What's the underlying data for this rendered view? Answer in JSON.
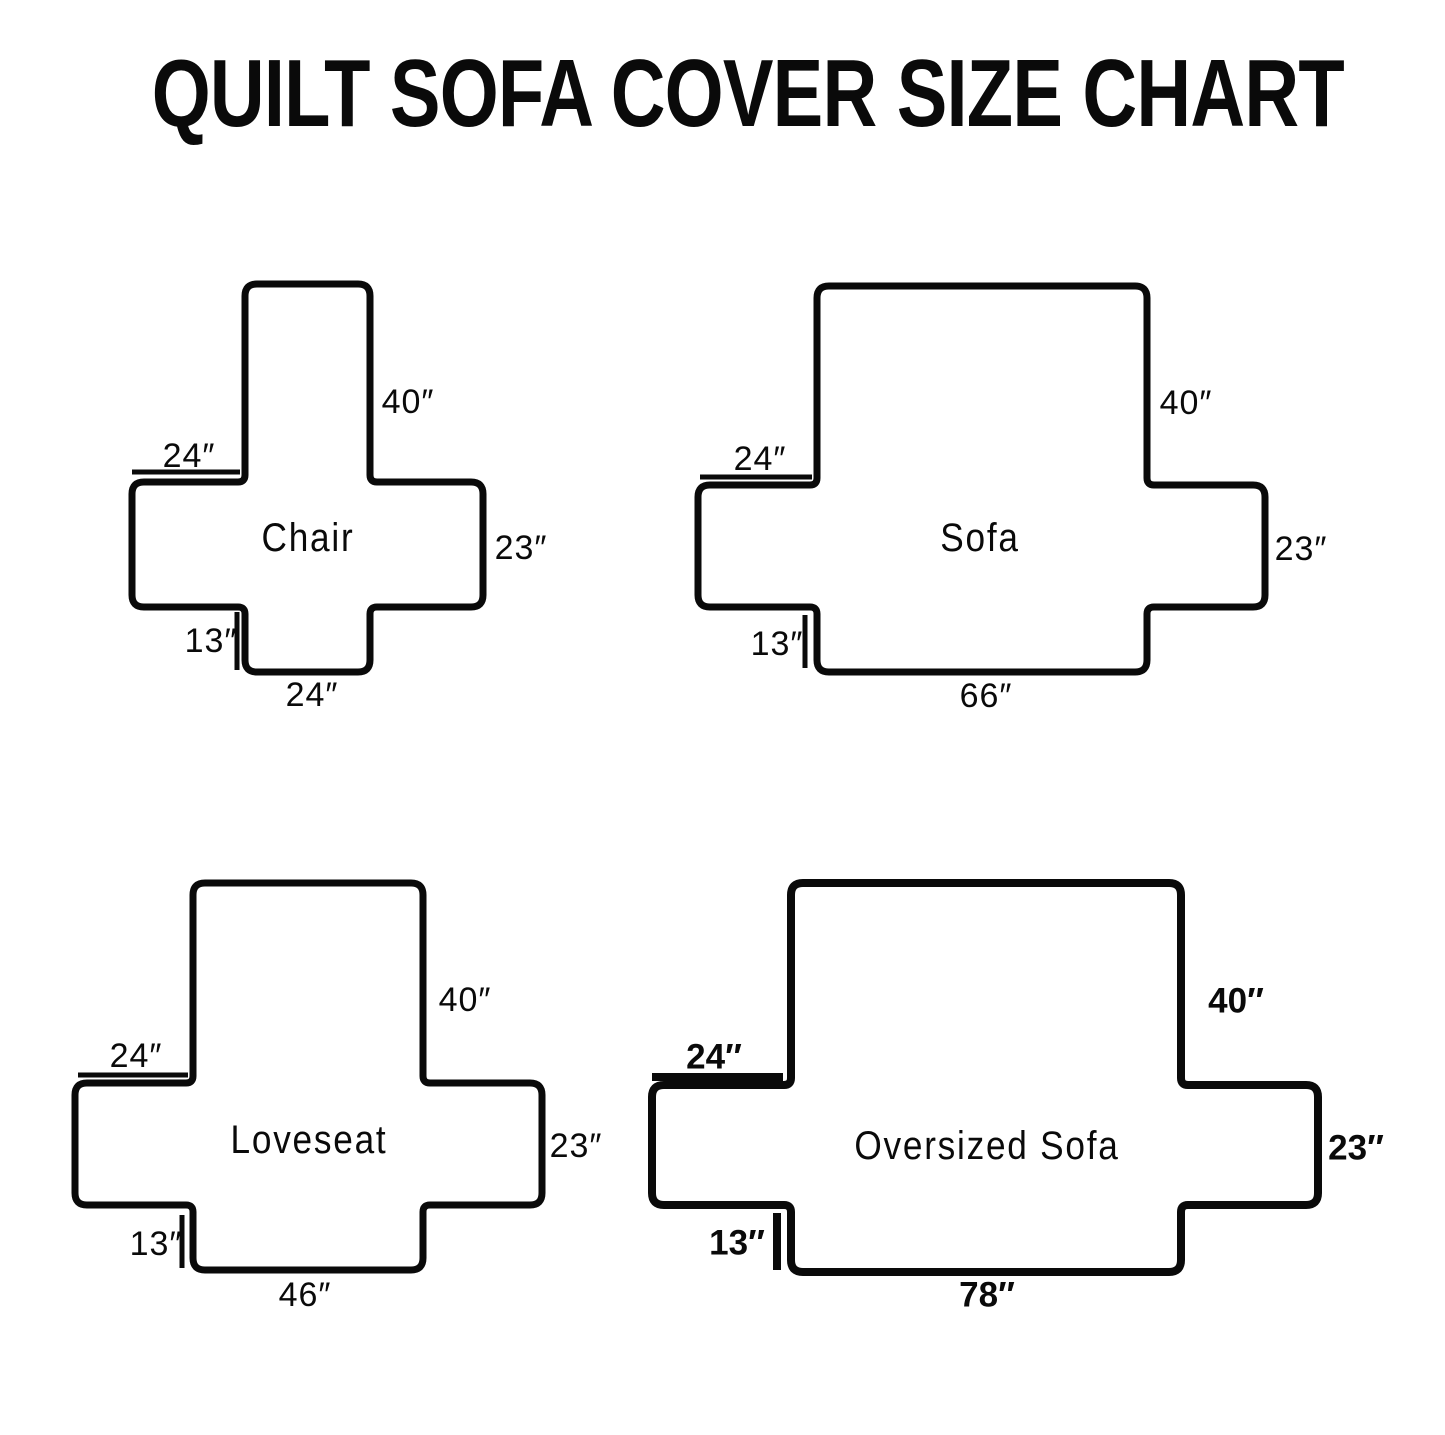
{
  "title": "QUILT SOFA COVER SIZE CHART",
  "colors": {
    "ink": "#0a0a0a",
    "background": "#ffffff"
  },
  "diagrams": {
    "chair": {
      "name": "Chair",
      "back_width": "24″",
      "back_height": "40″",
      "arm_depth": "23″",
      "front_drop": "13″",
      "seat_width": "24″"
    },
    "sofa": {
      "name": "Sofa",
      "back_width": "24″",
      "back_height": "40″",
      "arm_depth": "23″",
      "front_drop": "13″",
      "seat_width": "66″"
    },
    "loveseat": {
      "name": "Loveseat",
      "back_width": "24″",
      "back_height": "40″",
      "arm_depth": "23″",
      "front_drop": "13″",
      "seat_width": "46″"
    },
    "oversized": {
      "name": "Oversized Sofa",
      "back_width": "24″",
      "back_height": "40″",
      "arm_depth": "23″",
      "front_drop": "13″",
      "seat_width": "78″"
    }
  }
}
